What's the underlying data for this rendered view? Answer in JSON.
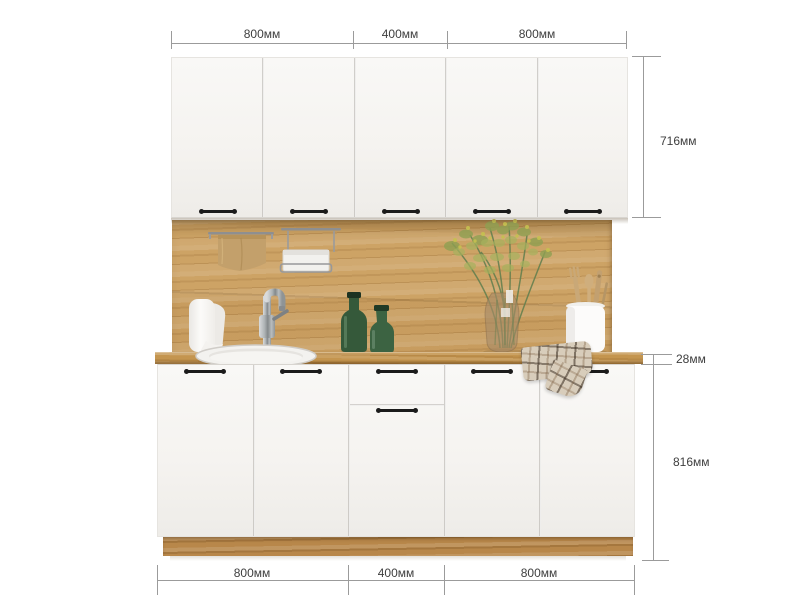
{
  "page": {
    "background": "#ffffff",
    "subject": "kitchen-cabinet-set-with-dimensions"
  },
  "dimensions": {
    "top": {
      "segments": [
        "800мм",
        "400мм",
        "800мм"
      ]
    },
    "bottom": {
      "segments": [
        "800мм",
        "400мм",
        "800мм"
      ]
    },
    "right": {
      "wall_cabinet_height": "716мм",
      "countertop_thickness": "28мм",
      "base_cabinet_height": "816мм"
    }
  },
  "cabinets": {
    "wall_doors": 5,
    "base_sections": 5,
    "middle_section_has_drawer": true,
    "door_color": "#f6f4f1",
    "handle_color": "#1b1b1b",
    "wood_color": "#cda365",
    "plinth_color": "#b8874a"
  },
  "annotation_style": {
    "line_color": "#9b9b9b",
    "text_color": "#3e3e3e"
  },
  "decor_items": [
    "paper-towel-roll",
    "towel-rail",
    "hanging-towel",
    "wall-rail-basket",
    "faucet",
    "round-sink",
    "green-glass-bottles",
    "flower-vase-bouquet",
    "utensil-holder",
    "plaid-towel"
  ]
}
